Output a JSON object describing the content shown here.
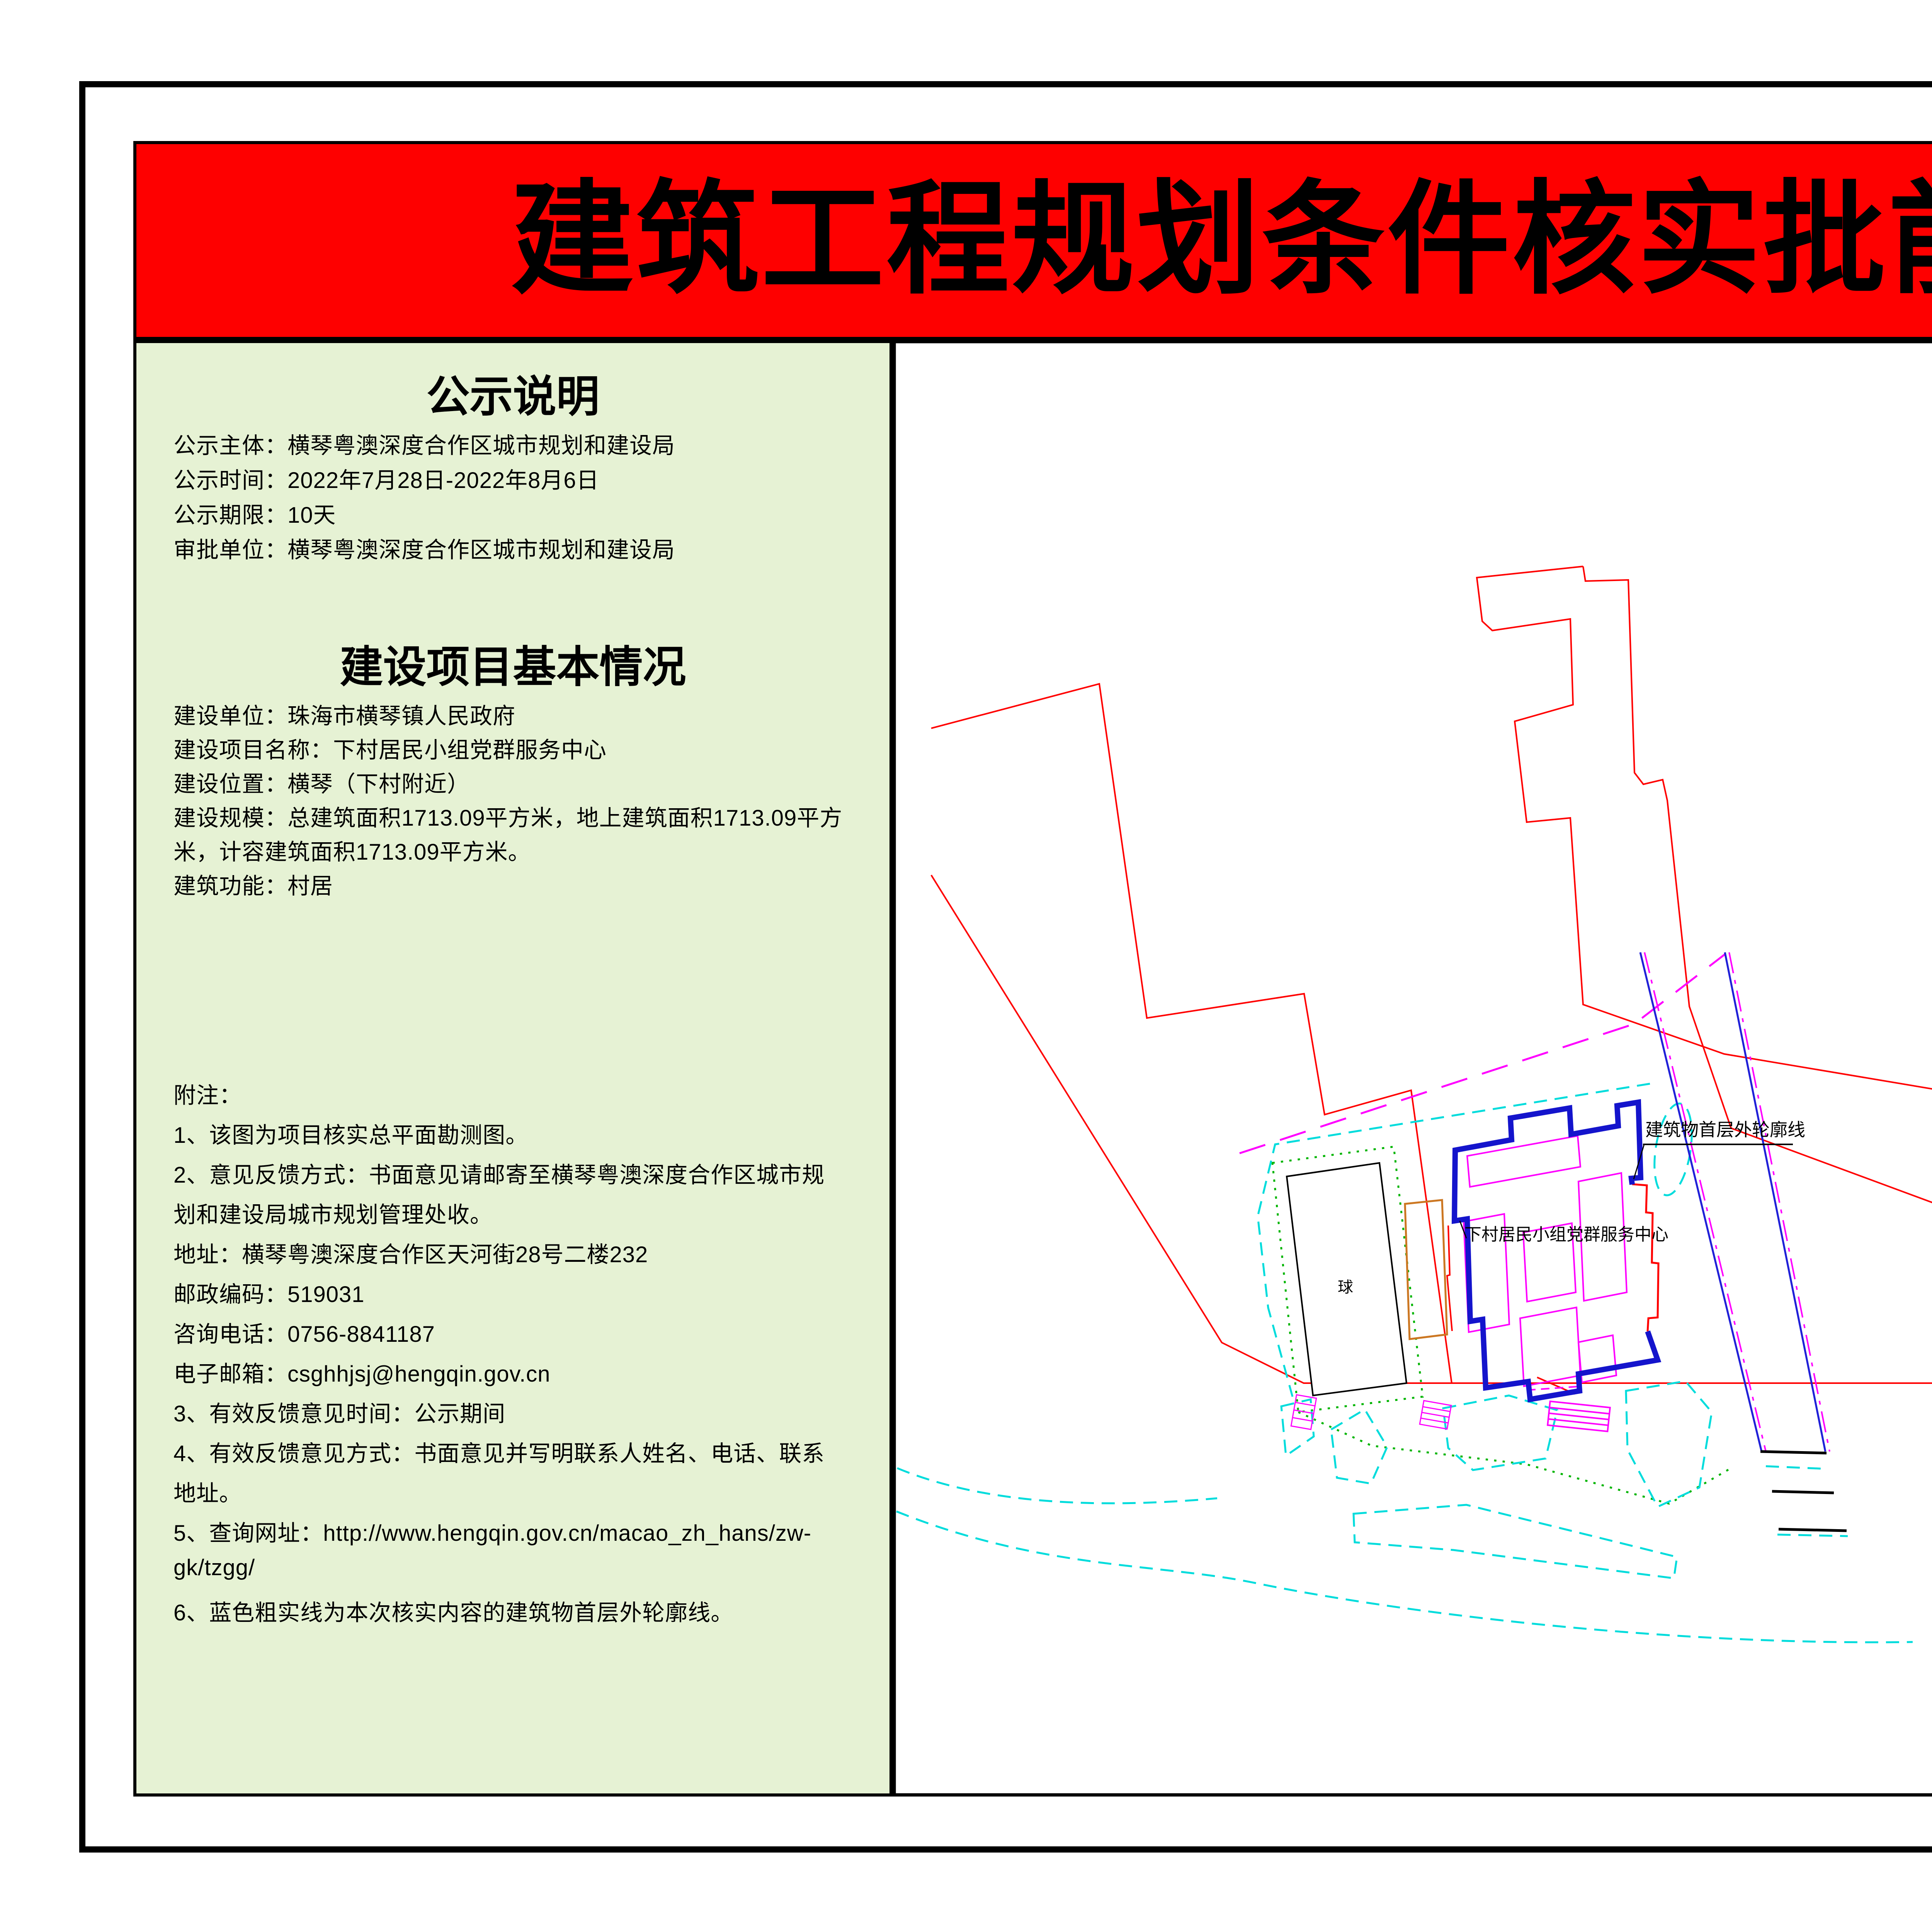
{
  "banner": {
    "title": "建筑工程规划条件核实批前公示",
    "bg_color": "#fe0000",
    "text_color": "#000000"
  },
  "notice": {
    "heading": "公示说明",
    "lines": [
      "公示主体：横琴粤澳深度合作区城市规划和建设局",
      "公示时间：2022年7月28日-2022年8月6日",
      "公示期限：10天",
      "审批单位：横琴粤澳深度合作区城市规划和建设局"
    ]
  },
  "project": {
    "heading": "建设项目基本情况",
    "lines": [
      "建设单位：珠海市横琴镇人民政府",
      "建设项目名称：下村居民小组党群服务中心",
      "建设位置：横琴（下村附近）",
      "建设规模：总建筑面积1713.09平方米，地上建筑面积1713.09平方",
      "米，计容建筑面积1713.09平方米。",
      "建筑功能：村居"
    ]
  },
  "notes": {
    "lines": [
      "附注：",
      "1、该图为项目核实总平面勘测图。",
      "2、意见反馈方式：书面意见请邮寄至横琴粤澳深度合作区城市规",
      "划和建设局城市规划管理处收。",
      "地址：横琴粤澳深度合作区天河街28号二楼232",
      "邮政编码：519031",
      "咨询电话：0756-8841187",
      "电子邮箱：csghhjsj@hengqin.gov.cn",
      "3、有效反馈意见时间：公示期间",
      "4、有效反馈意见方式：书面意见并写明联系人姓名、电话、联系",
      "地址。",
      "5、查询网址：http://www.hengqin.gov.cn/macao_zh_hans/zw-",
      "gk/tzgg/",
      "6、蓝色粗实线为本次核实内容的建筑物首层外轮廓线。"
    ]
  },
  "map": {
    "labels": {
      "court": "球",
      "building": "下村居民小组党群服务中心",
      "outline": "建筑物首层外轮廓线"
    },
    "colors": {
      "parcel_boundary": "#ff0000",
      "building_outline": "#1414cc",
      "rooms": "#ff00ff",
      "landscape": "#00dcdc",
      "greenery": "#00b400",
      "road": "#2020d8",
      "ramp": "#cc7722"
    }
  }
}
